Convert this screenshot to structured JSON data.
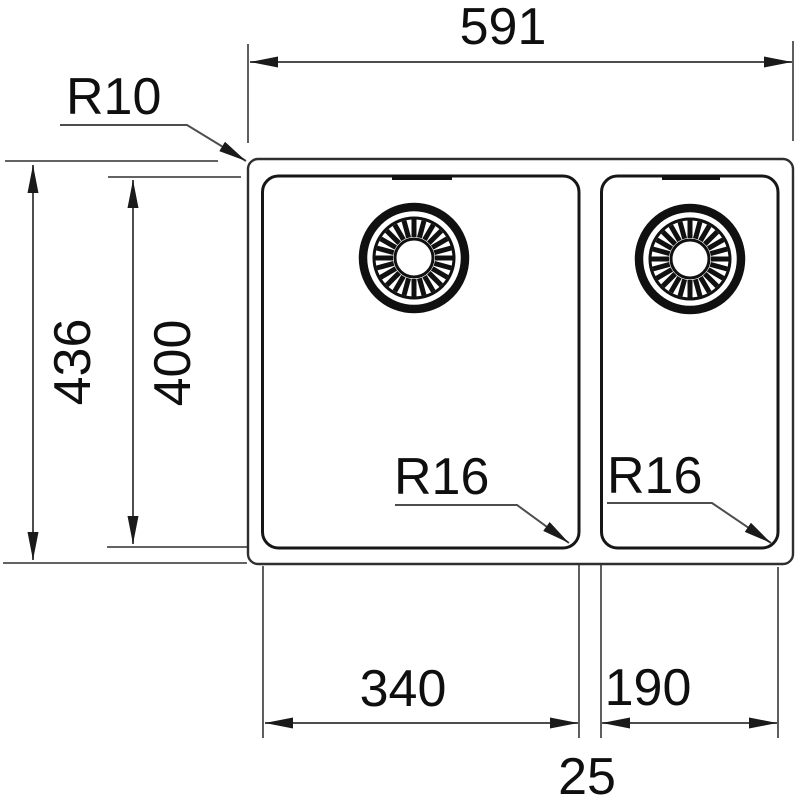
{
  "drawing": {
    "dimensions": {
      "overall_width": "591",
      "overall_height": "436",
      "bowl_depth": "400",
      "left_bowl_width": "340",
      "right_bowl_width": "190",
      "center_gap": "25",
      "outer_corner_radius": "R10",
      "left_bowl_corner_radius": "R16",
      "right_bowl_corner_radius": "R16"
    },
    "colors": {
      "background": "#ffffff",
      "dimension_line_gray": "#4d4d4d",
      "outline_black": "#161616",
      "text_black": "#0f0f0f"
    }
  }
}
